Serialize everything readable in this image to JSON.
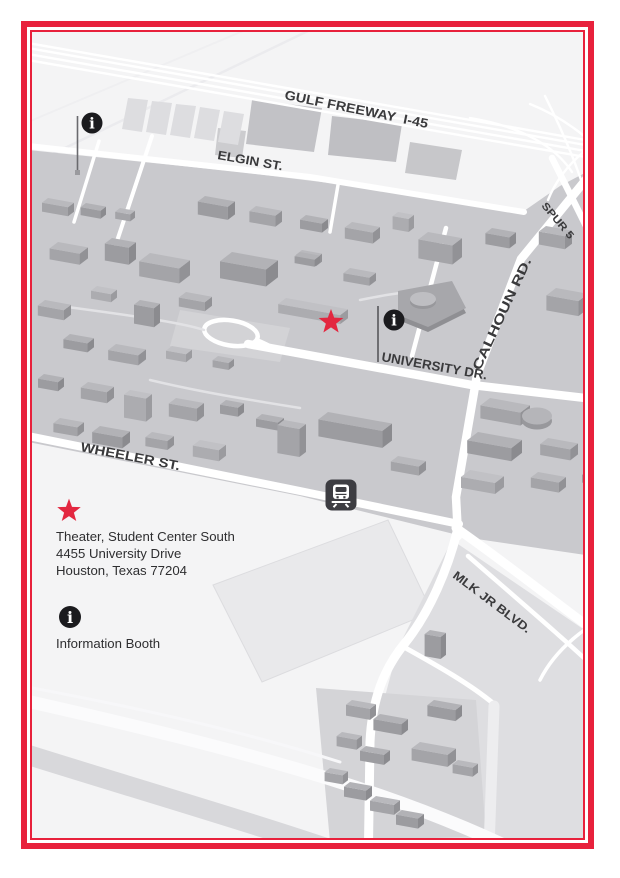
{
  "page": {
    "background": "#ffffff",
    "border_color": "#e8213c"
  },
  "map": {
    "street_labels": {
      "gulf_freeway": "GULF FREEWAY  I-45",
      "elgin": "ELGIN ST.",
      "spur5": "SPUR 5",
      "calhoun": "CALHOUN RD.",
      "university": "UNIVERSITY DR.",
      "wheeler": "WHEELER ST.",
      "mlk": "MLK JR BLVD."
    },
    "markers": {
      "info_glyph": "i",
      "star_color": "#e32740",
      "info_bg": "#1b1b1e",
      "transit_bg": "#3d3d42"
    }
  },
  "legend": {
    "theater_line1": "Theater, Student Center South",
    "theater_line2": "4455 University Drive",
    "theater_line3": "Houston, Texas 77204",
    "info_label": "Information Booth"
  }
}
